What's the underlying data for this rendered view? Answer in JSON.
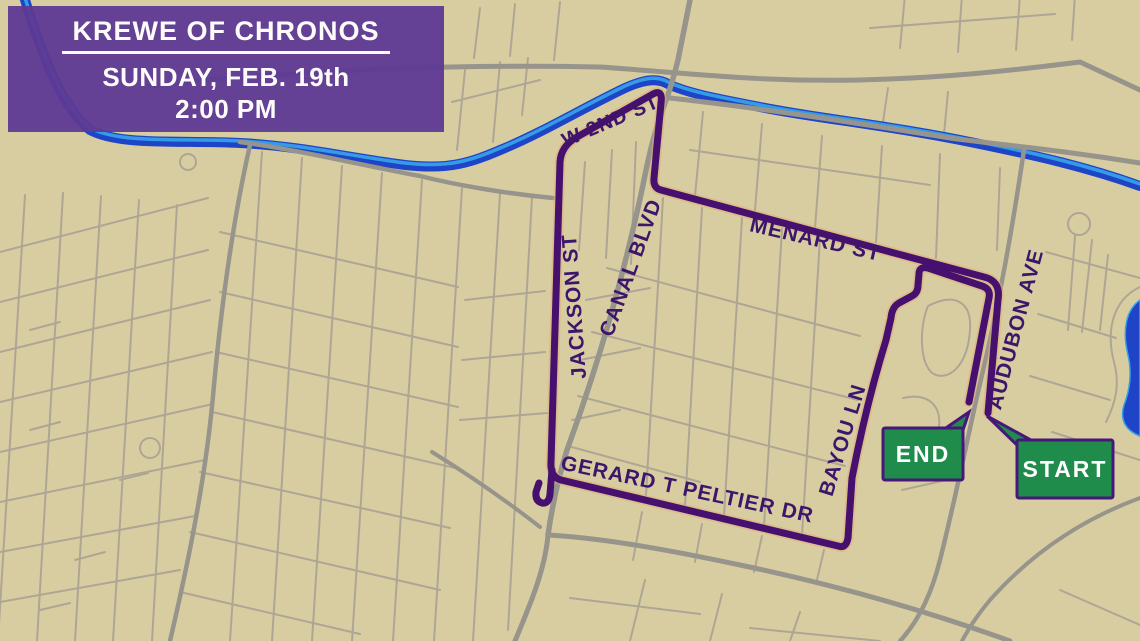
{
  "header": {
    "title": "KREWE OF CHRONOS",
    "date": "SUNDAY, FEB. 19th",
    "time": "2:00 PM"
  },
  "markers": {
    "start_label": "START",
    "end_label": "END"
  },
  "streets": [
    {
      "name": "w-2nd-st",
      "label": "W 2ND ST"
    },
    {
      "name": "menard-st",
      "label": "MENARD ST"
    },
    {
      "name": "jackson-st",
      "label": "JACKSON ST"
    },
    {
      "name": "canal-blvd",
      "label": "CANAL BLVD"
    },
    {
      "name": "bayou-ln",
      "label": "BAYOU LN"
    },
    {
      "name": "audubon-ave",
      "label": "AUDUBON AVE"
    },
    {
      "name": "gerard-t-peltier-dr",
      "label": "GERARD T PELTIER DR"
    }
  ],
  "colors": {
    "background_tan": "#d8cda1",
    "minor_street": "#aaa293",
    "major_road": "#97948b",
    "water_blue": "#1e44c8",
    "water_highlight": "#38a0e8",
    "route_purple": "#45106e",
    "route_halo": "#e2a874",
    "label_purple": "#3d156b",
    "header_purple": "#5e3a94",
    "marker_green": "#1f8c4c",
    "marker_border": "#47187a",
    "text_white": "#ffffff"
  }
}
